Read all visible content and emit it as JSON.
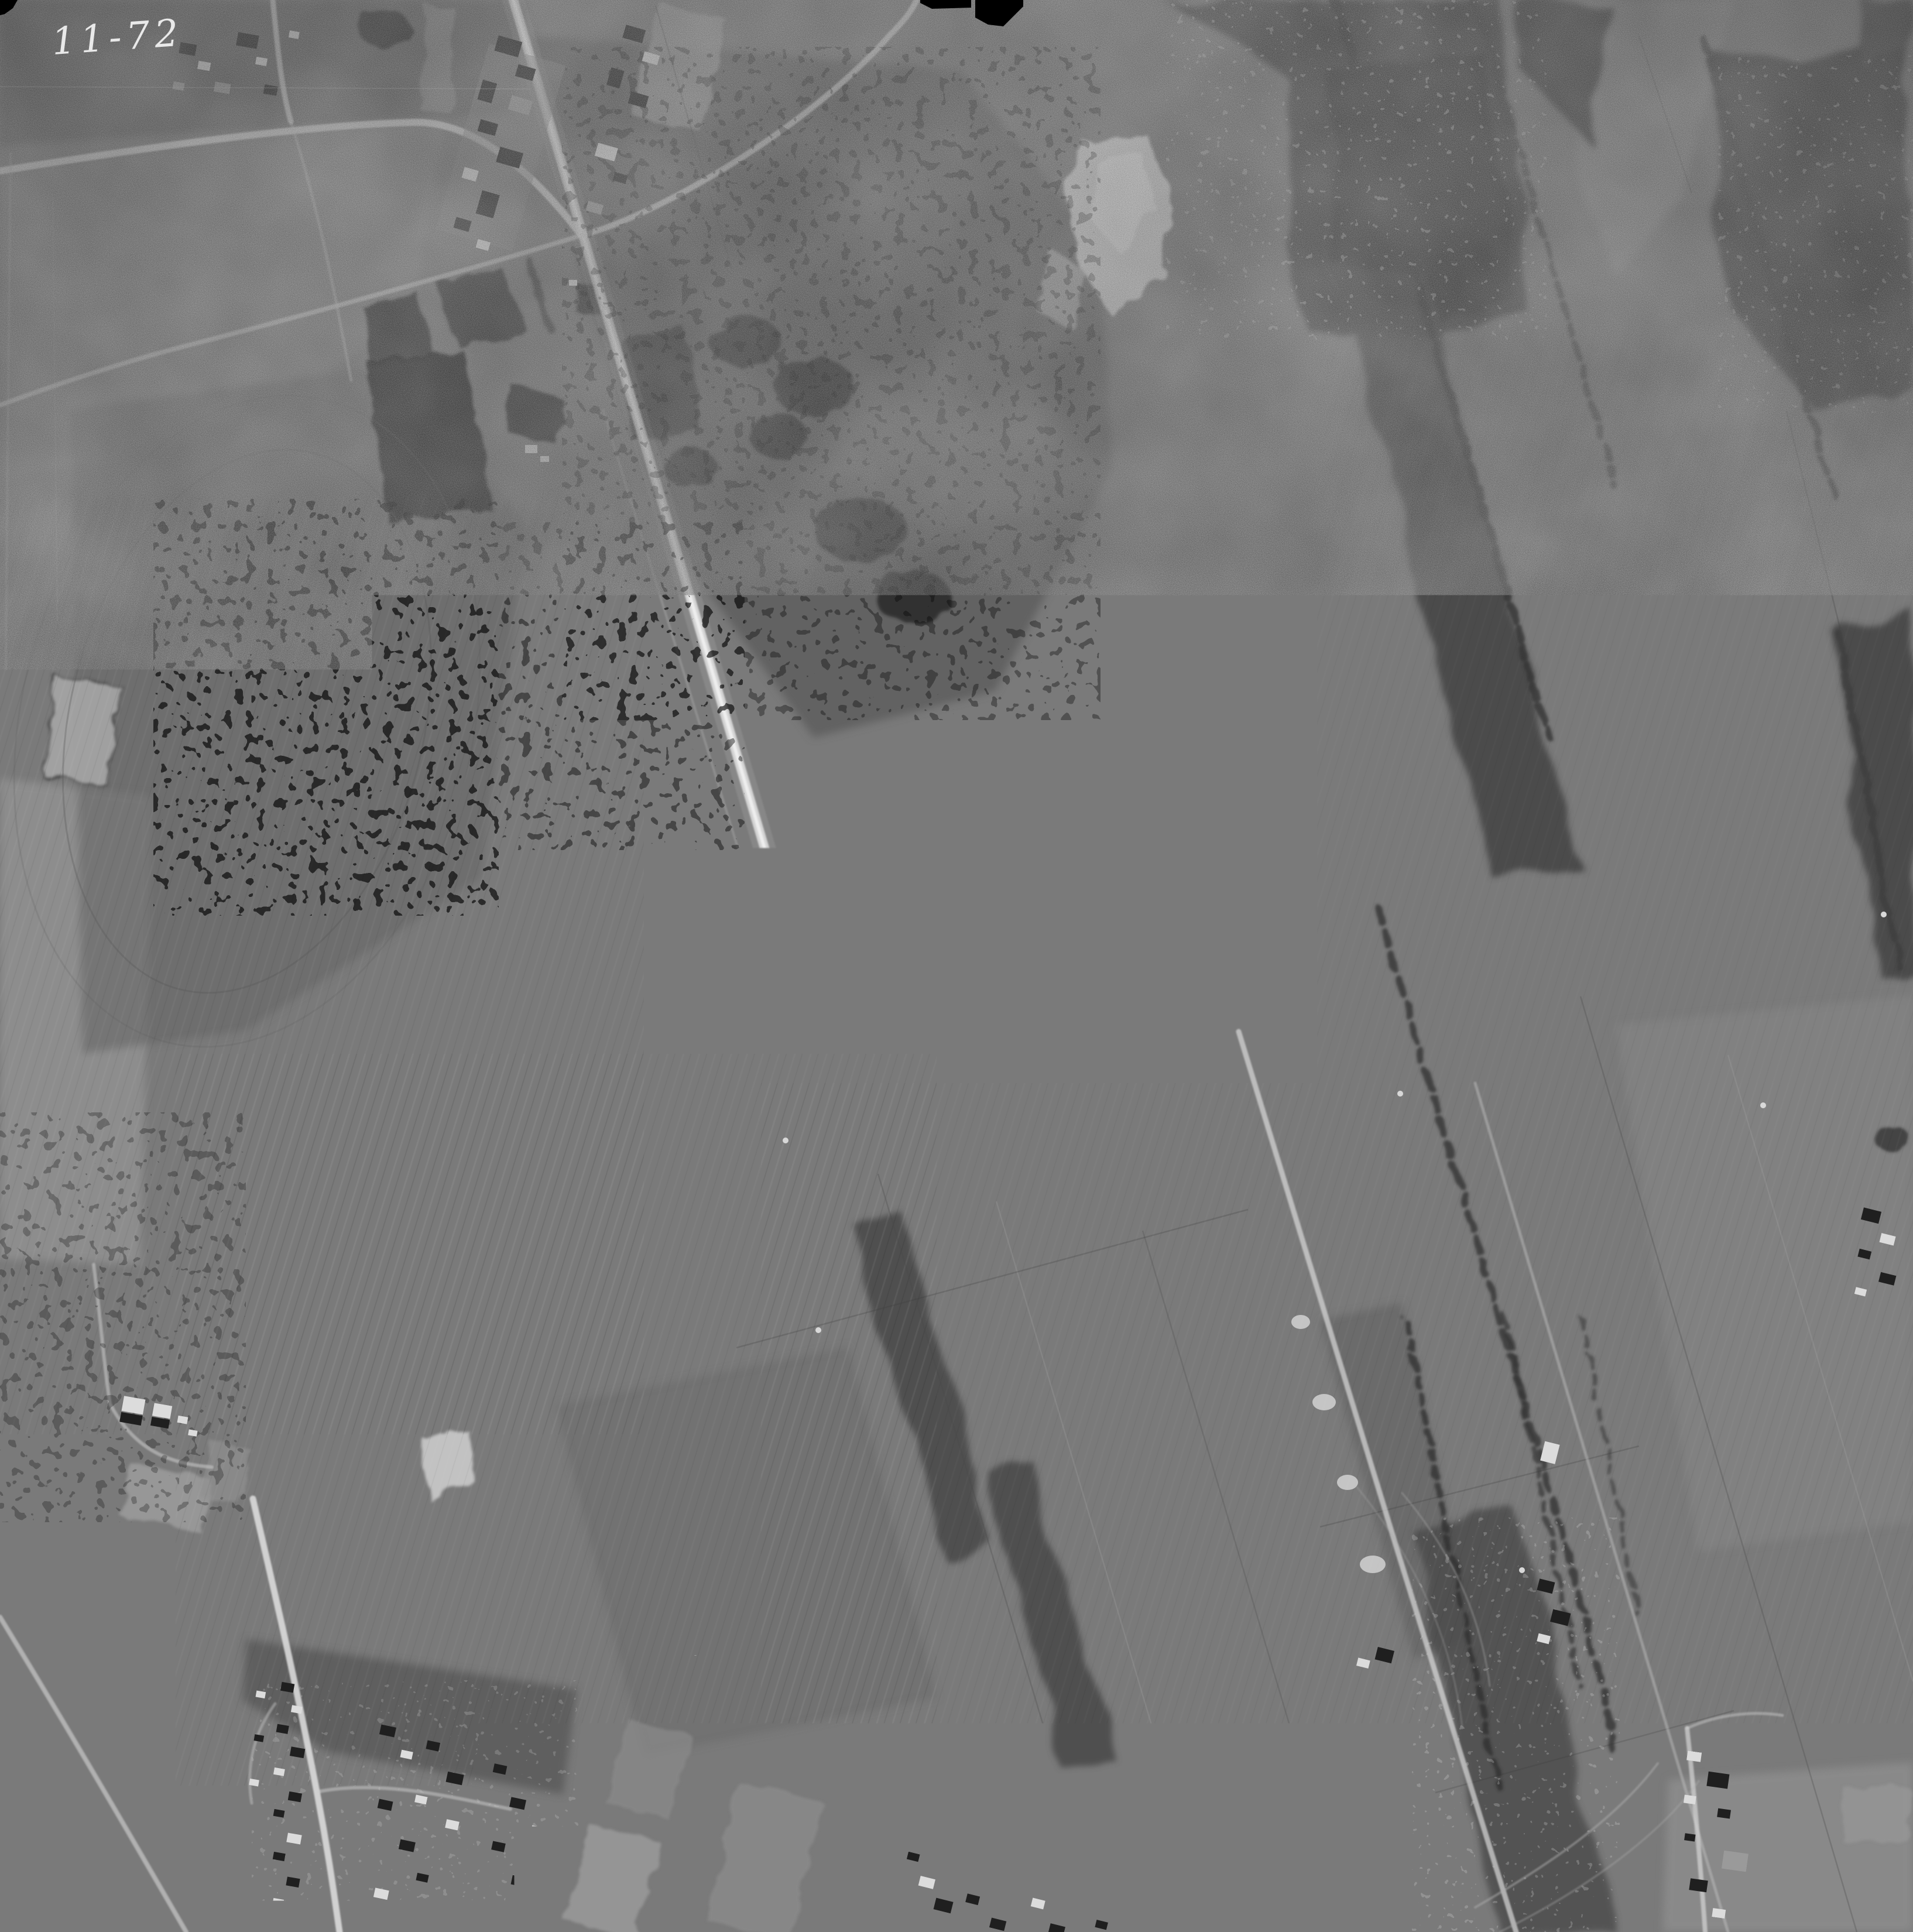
{
  "photo": {
    "frame_annotation": "11-72",
    "watermark": "Archives de la Ville de Montréal"
  },
  "palette": {
    "film_black": "#000000",
    "terrain_base_gray": "#7a7a7a",
    "light_field_gray": "#959595",
    "scrub_gray": "#5d5d5d",
    "forest_gray": "#3f3f3f",
    "burned_patch_gray": "#161616",
    "road_white": "#e7e7e7",
    "gravel_pit_white": "#dedede",
    "annotation_white": "#f4f4f4",
    "watermark_white": "#f5f2ec"
  },
  "fiducial_marks": {
    "positions": [
      "top-center",
      "bottom-center",
      "left-center",
      "right-center"
    ]
  }
}
